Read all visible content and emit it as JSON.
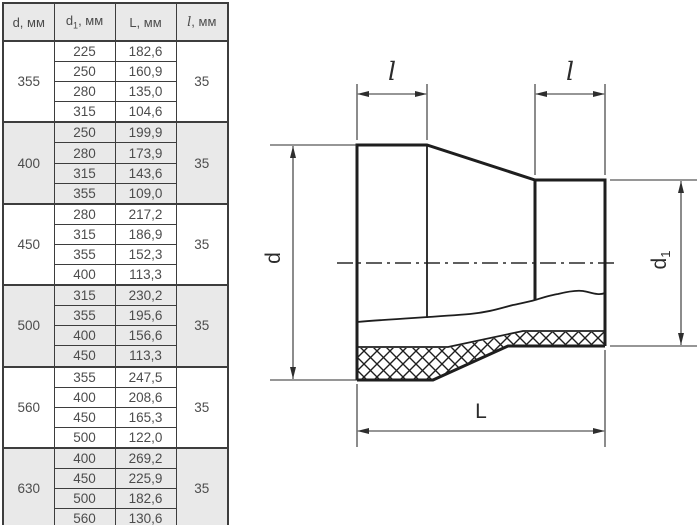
{
  "table": {
    "headers": {
      "d": "d, мм",
      "d1": {
        "base": "d",
        "sub": "1",
        "rest": ", мм"
      },
      "L": "L, мм",
      "l": {
        "base": "l",
        "rest": ", мм"
      }
    },
    "groups": [
      {
        "d": "355",
        "l": "35",
        "rows": [
          [
            "225",
            "182,6"
          ],
          [
            "250",
            "160,9"
          ],
          [
            "280",
            "135,0"
          ],
          [
            "315",
            "104,6"
          ]
        ]
      },
      {
        "d": "400",
        "l": "35",
        "rows": [
          [
            "250",
            "199,9"
          ],
          [
            "280",
            "173,9"
          ],
          [
            "315",
            "143,6"
          ],
          [
            "355",
            "109,0"
          ]
        ]
      },
      {
        "d": "450",
        "l": "35",
        "rows": [
          [
            "280",
            "217,2"
          ],
          [
            "315",
            "186,9"
          ],
          [
            "355",
            "152,3"
          ],
          [
            "400",
            "113,3"
          ]
        ]
      },
      {
        "d": "500",
        "l": "35",
        "rows": [
          [
            "315",
            "230,2"
          ],
          [
            "355",
            "195,6"
          ],
          [
            "400",
            "156,6"
          ],
          [
            "450",
            "113,3"
          ]
        ]
      },
      {
        "d": "560",
        "l": "35",
        "rows": [
          [
            "355",
            "247,5"
          ],
          [
            "400",
            "208,6"
          ],
          [
            "450",
            "165,3"
          ],
          [
            "500",
            "122,0"
          ]
        ]
      },
      {
        "d": "630",
        "l": "35",
        "rows": [
          [
            "400",
            "269,2"
          ],
          [
            "450",
            "225,9"
          ],
          [
            "500",
            "182,6"
          ],
          [
            "560",
            "130,6"
          ]
        ]
      }
    ]
  },
  "diagram": {
    "labels": {
      "l_left": "l",
      "l_right": "l",
      "L": "L",
      "d": "d",
      "d1_base": "d",
      "d1_sub": "1"
    }
  },
  "colors": {
    "grid": "#3d3d3d",
    "band_gray": "#e9e9e9",
    "text": "#4c4c4c",
    "line": "#1e1e1e"
  }
}
